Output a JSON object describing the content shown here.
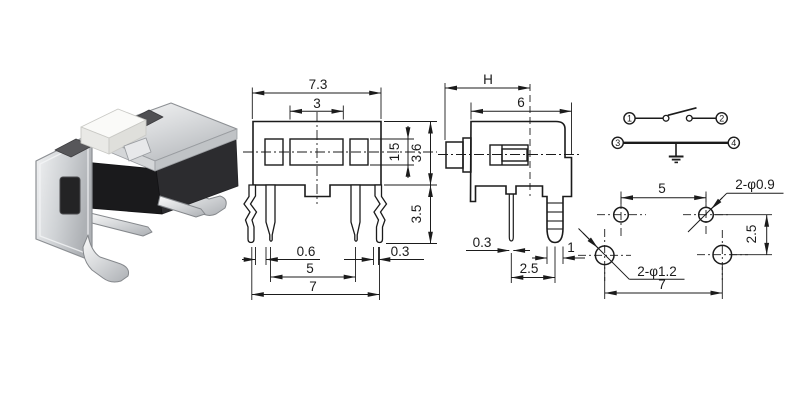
{
  "title": "tactile switch technical drawing",
  "front_view": {
    "dim_total_width": "7.3",
    "dim_button_width": "3",
    "dim_inner_height": "1.5",
    "dim_body_height": "3.6",
    "dim_leg_length": "3.5",
    "dim_leg_offset": "0.6",
    "dim_inner_pitch": "5",
    "dim_outer_pitch": "7",
    "dim_leg_thickness": "0.3"
  },
  "side_view": {
    "dim_height": "H",
    "dim_depth": "6",
    "dim_pin_thickness": "0.3",
    "dim_pin_offset": "2.5",
    "dim_leg_width": "1"
  },
  "circuit": {
    "terminal_1": "1",
    "terminal_2": "2",
    "terminal_3": "3",
    "terminal_4": "4"
  },
  "pcb_layout": {
    "dim_top_pitch": "5",
    "label_small_holes": "2-φ0.9",
    "dim_row_pitch": "2.5",
    "label_large_holes": "2-φ1.2",
    "dim_bottom_pitch": "7"
  },
  "colors": {
    "line": "#1b1b1b",
    "metal_light": "#f0f1f2",
    "metal_mid": "#c2c5c9",
    "metal_dark": "#8d9094",
    "plastic_black": "#1a1a1c",
    "plastic_gray": "#56565a",
    "button_white": "#f7f7f5"
  }
}
